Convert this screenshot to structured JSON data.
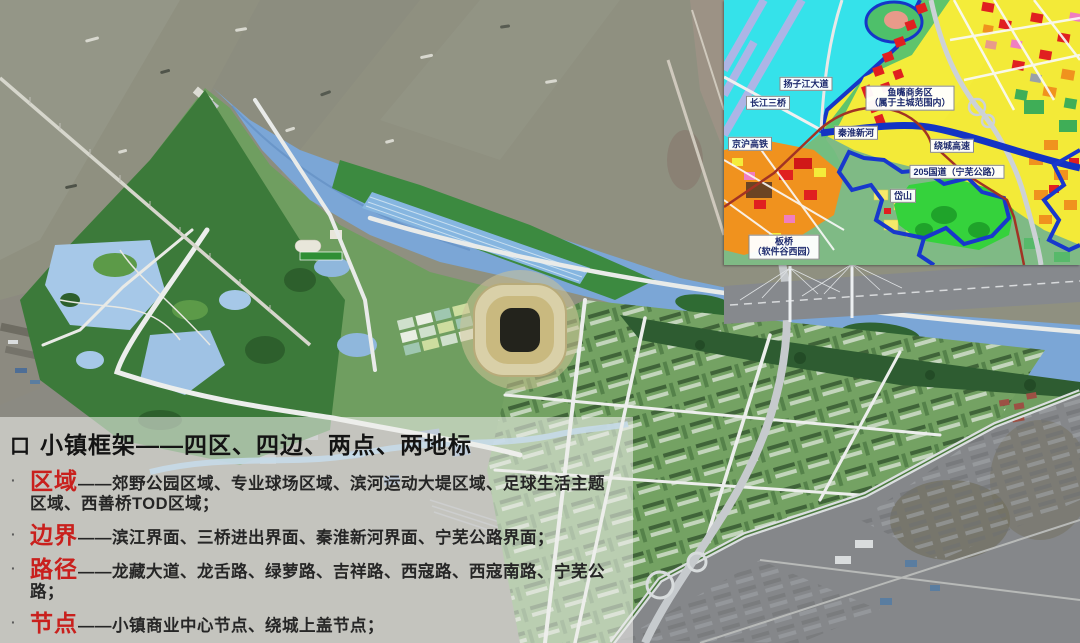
{
  "slide": {
    "title_bullet": "口",
    "title": "小镇框架——四区、四边、两点、两地标",
    "item_bullet": "·",
    "items": [
      {
        "keyword": "区域",
        "text": "——郊野公园区域、专业球场区域、滨河运动大堤区域、足球生活主题区域、西善桥TOD区域；"
      },
      {
        "keyword": "边界",
        "text": "——滨江界面、三桥进出界面、秦淮新河界面、宁芜公路界面；"
      },
      {
        "keyword": "路径",
        "text": "——龙藏大道、龙舌路、绿萝路、吉祥路、西寇路、西寇南路、宁芜公路；"
      },
      {
        "keyword": "节点",
        "text": "——小镇商业中心节点、绕城上盖节点；"
      },
      {
        "keyword": "地标",
        "text": "——体育主场馆、商业中心150米高层；"
      }
    ]
  },
  "inset_map": {
    "labels": {
      "yangzijiang_avenue": "扬子江大道",
      "changjiang_third_bridge": "长江三桥",
      "jinghu_highspeed_rail": "京沪高铁",
      "qinhuai_new_river": "秦淮新河",
      "ring_expressway": "绕城高速",
      "g205_ningwu": "205国道（宁芜公路）",
      "daishan": "岱山",
      "banqiao_line1": "板桥",
      "banqiao_line2": "（软件谷西园）",
      "yuzui_line1": "鱼嘴商务区",
      "yuzui_line2": "（属于主城范围内）"
    }
  },
  "colors": {
    "keyword_red": "#c9201d",
    "title_black": "#141414",
    "panel_bg": "rgba(238,238,235,0.58)",
    "river_blue": "#7ba6d6",
    "plan_green": "#6f9e60",
    "park_green": "#3c7a3a",
    "muddy_water": "#8f9080",
    "inset_water_cyan": "#35e2ea",
    "inset_yellow": "#f3ea38",
    "inset_orange": "#f0921e",
    "inset_red": "#e02020",
    "boundary_blue": "#1536c8",
    "rail_red": "#a23324"
  }
}
